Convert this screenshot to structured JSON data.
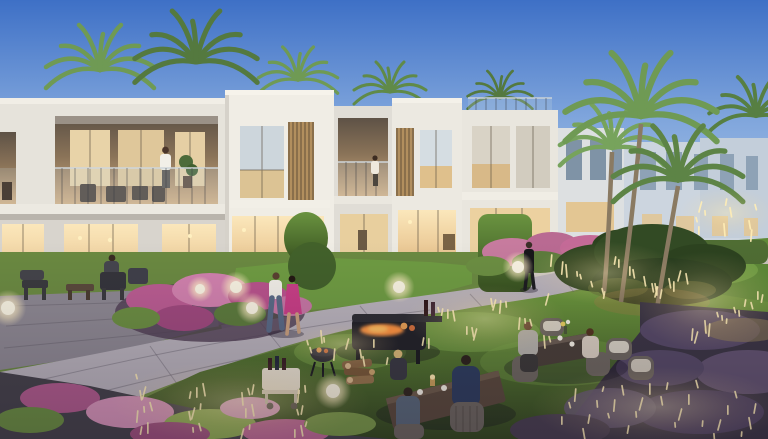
{
  "meta": {
    "type": "architectural-render",
    "description": "Modern white townhouse community at dusk: two-storey villas with warm-lit interiors, balconies with residents, palm trees, landscaped gardens with pink flower beds, a winding paved path, residents strolling and dining outdoors around barbecue grills, and glowing garden lights in ornamental grasses.",
    "time_of_day": "dusk"
  },
  "palette": {
    "sky_top": "#3e70c6",
    "sky_mid": "#7fa5dc",
    "sky_horizon": "#cfdbee",
    "facade_light": "#efece4",
    "facade_shade": "#dcd8d1",
    "wood_light": "#b28f5e",
    "wood_dark": "#8a6f4b",
    "window_warm": "#f6dca6",
    "interior_glow": "#e2b97c",
    "hedge_green": "#587d35",
    "lawn_bright": "#7fae4c",
    "lawn_dark": "#35491f",
    "path_grey": "#b9b3bb",
    "patio_grey": "#8e8992",
    "flower_magenta": "#bb5d92",
    "flower_pink": "#d795b8",
    "grass_purple": "#5a4c6b",
    "light_warm": "#ffedb6",
    "tree_dark": "#2c421f",
    "distant_haze": "#ccd5df",
    "grill_dark": "#232328",
    "fire_orange": "#ff9440",
    "dress_magenta": "#c93f86",
    "denim_blue": "#5a6b86",
    "shirt_white": "#f2efe8"
  },
  "scene": {
    "objects": [
      "townhouse-row",
      "balconies",
      "palm-trees",
      "garden-path",
      "flower-beds",
      "lawn",
      "outdoor-dining",
      "bbq-grills",
      "garden-lights",
      "residents",
      "feature-tree",
      "hedges"
    ],
    "palms_back": [
      {
        "x": 100,
        "y": 70,
        "s": 1.5,
        "flip": false,
        "color": "#6f9a54"
      },
      {
        "x": 196,
        "y": 62,
        "s": 1.7,
        "flip": true,
        "color": "#54793f"
      },
      {
        "x": 298,
        "y": 80,
        "s": 1.1,
        "flip": false,
        "color": "#6f9a54"
      },
      {
        "x": 390,
        "y": 92,
        "s": 1.0,
        "flip": true,
        "color": "#608a48"
      },
      {
        "x": 500,
        "y": 98,
        "s": 0.9,
        "flip": false,
        "color": "#54793f"
      },
      {
        "x": 756,
        "y": 116,
        "s": 1.3,
        "flip": true,
        "color": "#577f42"
      }
    ],
    "palms_front": [
      {
        "x": 612,
        "y": 148,
        "s": 1.45,
        "flip": true,
        "color": "#77a35c",
        "trunk": "M612,152 C610,200 608,250 604,292"
      },
      {
        "x": 641,
        "y": 116,
        "s": 2.1,
        "flip": false,
        "color": "#6f9a54",
        "trunk": "M641,124 C636,180 628,250 621,302"
      },
      {
        "x": 678,
        "y": 180,
        "s": 1.8,
        "flip": true,
        "color": "#5d8446",
        "trunk": "M678,186 C670,230 660,290 653,332"
      }
    ],
    "light_clusters": [
      {
        "x": 135,
        "y": 374,
        "w": 210,
        "h": 56,
        "count": 30
      },
      {
        "x": 420,
        "y": 296,
        "w": 130,
        "h": 46,
        "count": 18
      },
      {
        "x": 545,
        "y": 252,
        "w": 120,
        "h": 42,
        "count": 16
      },
      {
        "x": 556,
        "y": 380,
        "w": 205,
        "h": 54,
        "count": 28
      },
      {
        "x": 648,
        "y": 268,
        "w": 118,
        "h": 66,
        "count": 20
      },
      {
        "x": 688,
        "y": 196,
        "w": 78,
        "h": 34,
        "count": 10
      },
      {
        "x": 296,
        "y": 330,
        "w": 92,
        "h": 28,
        "count": 10
      }
    ],
    "lamp_spheres": [
      {
        "x": 8,
        "y": 308,
        "r": 7
      },
      {
        "x": 200,
        "y": 289,
        "r": 5
      },
      {
        "x": 236,
        "y": 287,
        "r": 6
      },
      {
        "x": 252,
        "y": 308,
        "r": 6
      },
      {
        "x": 399,
        "y": 287,
        "r": 6
      },
      {
        "x": 518,
        "y": 267,
        "r": 6
      },
      {
        "x": 333,
        "y": 391,
        "r": 7
      }
    ]
  }
}
